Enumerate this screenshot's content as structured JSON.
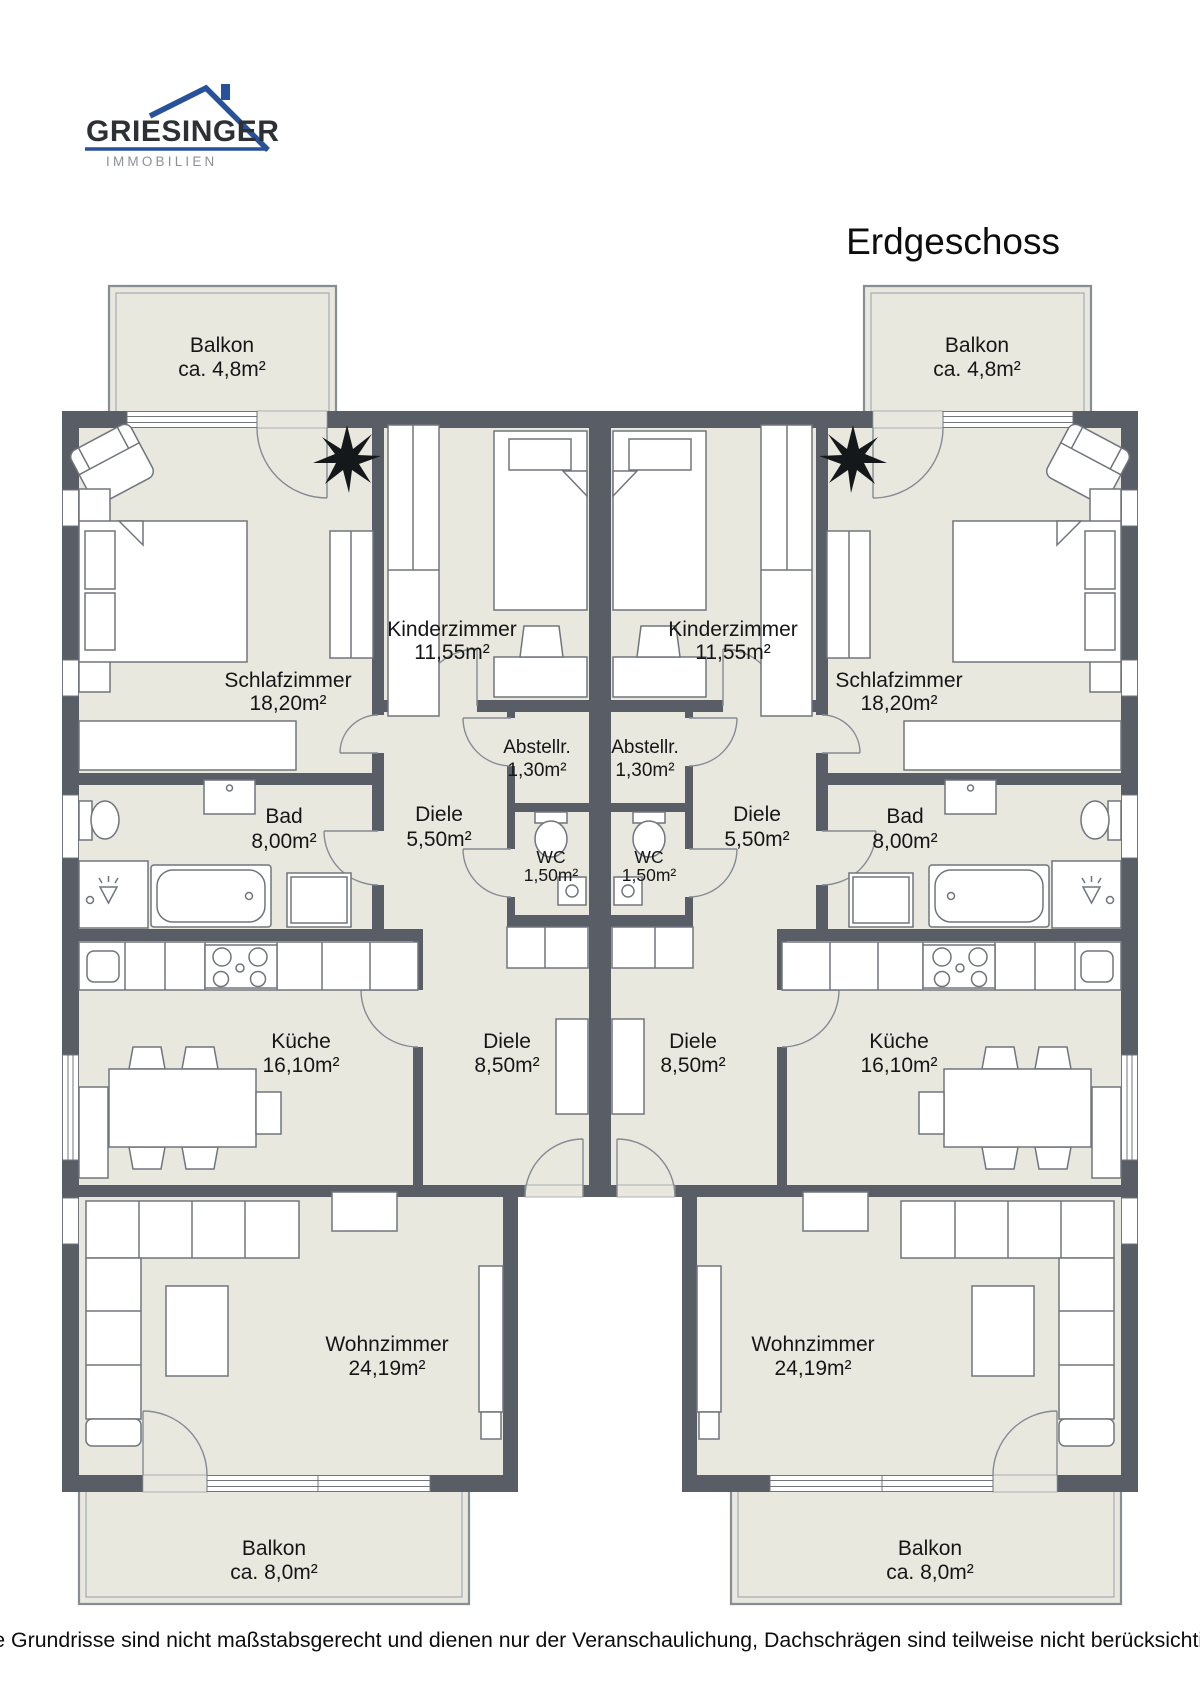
{
  "brand": {
    "name": "GRIESINGER",
    "tagline": "IMMOBILIEN"
  },
  "title": "Erdgeschoss",
  "disclaimer": "Die Grundrisse sind nicht maßstabsgerecht und dienen nur der Veranschaulichung, Dachschrägen sind teilweise nicht berücksichtigt.",
  "rooms": {
    "balkon_oben": {
      "name": "Balkon",
      "area": "ca. 4,8m²"
    },
    "schlafzimmer": {
      "name": "Schlafzimmer",
      "area": "18,20m²"
    },
    "kinderzimmer": {
      "name": "Kinderzimmer",
      "area": "11,55m²"
    },
    "abstellraum": {
      "name": "Abstellr.",
      "area": "1,30m²"
    },
    "diele_klein": {
      "name": "Diele",
      "area": "5,50m²"
    },
    "bad": {
      "name": "Bad",
      "area": "8,00m²"
    },
    "wc": {
      "name": "WC",
      "area": "1,50m²"
    },
    "kueche": {
      "name": "Küche",
      "area": "16,10m²"
    },
    "diele_gross": {
      "name": "Diele",
      "area": "8,50m²"
    },
    "wohnzimmer": {
      "name": "Wohnzimmer",
      "area": "24,19m²"
    },
    "balkon_unten": {
      "name": "Balkon",
      "area": "ca. 8,0m²"
    }
  },
  "colors": {
    "wall": "#595e66",
    "floor": "#e9e8df",
    "accent_blue": "#27529b"
  }
}
